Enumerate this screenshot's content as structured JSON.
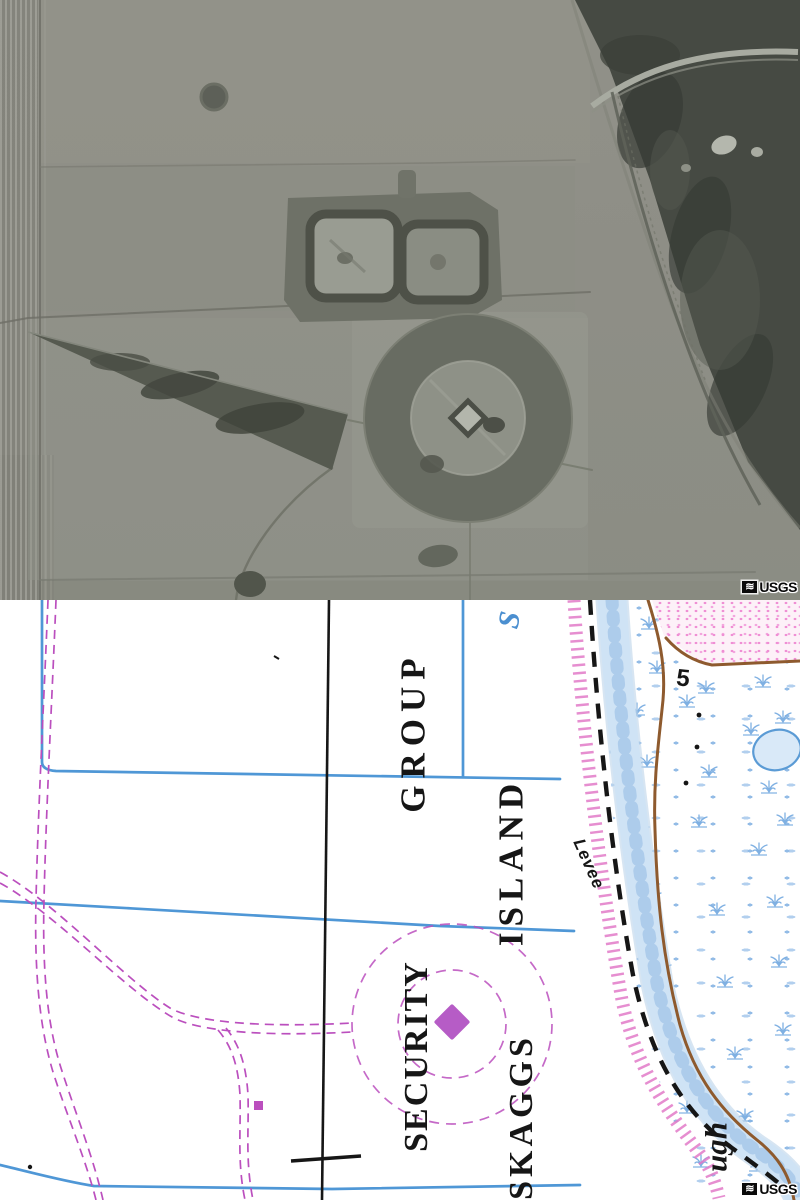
{
  "photo_panel": {
    "watermark": "USGS",
    "logo_glyph": "≋"
  },
  "map_panel": {
    "watermark": "USGS",
    "logo_glyph": "≋",
    "labels": {
      "group": "GROUP",
      "island": "ISLAND",
      "security": "SECURITY",
      "skaggs": "SKAGGS",
      "levee": "Levee",
      "spot_elevation": "5",
      "water_initial": "S",
      "slough_fragment": "ugh"
    }
  },
  "colors": {
    "ink": "#161616",
    "blue_line": "#4f97d6",
    "channel_fill": "#cfe3f5",
    "channel_edge": "#bcd4ea",
    "channel_mottle": "#a9c9ea",
    "marsh_symbol": "#7fb0e2",
    "marsh_symbol_light": "#a5c7ec",
    "magenta": "#bb4fbe",
    "magenta_fill": "#b65cc6",
    "pink_hatch": "#e27ac8",
    "pink_area_bg": "#fdf1f8",
    "pink_area_dot": "#ef8fd4",
    "brown": "#8e5a2e",
    "water_fill": "#d9e9f8",
    "blue_letter": "#4b8fd0",
    "photo_field": "#8f8f87",
    "photo_marsh": "#464a43"
  }
}
